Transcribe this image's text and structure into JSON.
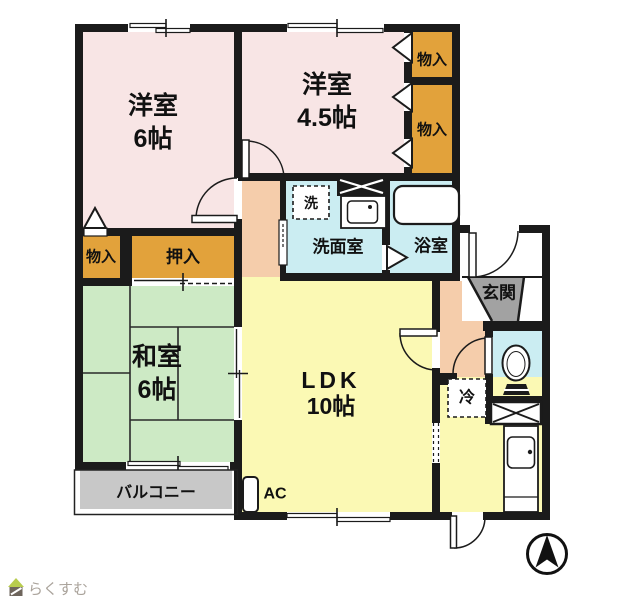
{
  "floorplan": {
    "rooms": {
      "western6": {
        "name": "洋室",
        "size": "6帖"
      },
      "western45": {
        "name": "洋室",
        "size": "4.5帖"
      },
      "japanese6": {
        "name": "和室",
        "size": "6帖"
      },
      "ldk": {
        "name": "LDK",
        "size": "10帖"
      },
      "washroom": {
        "name": "洗面室"
      },
      "bathroom": {
        "name": "浴室"
      },
      "entrance": {
        "name": "玄関"
      },
      "balcony": {
        "name": "バルコニー"
      }
    },
    "closets": {
      "closet_left": "物入",
      "oshiire": "押入",
      "closet_top_right": "物入",
      "closet_bottom_right": "物入"
    },
    "fixtures": {
      "washer": "洗",
      "fridge": "冷",
      "air_conditioner": "AC"
    },
    "watermark": "らくすむ",
    "colors": {
      "wall": "#1b1b1b",
      "western_room": "#f8e5e5",
      "closet": "#e2a23b",
      "tatami_room": "#cdeac5",
      "ldk": "#fbf9b4",
      "wet_area": "#cbedf2",
      "hallway": "#f5cdab",
      "balcony": "#c8c8c8",
      "entrance_floor": "#a2a2a2"
    }
  }
}
